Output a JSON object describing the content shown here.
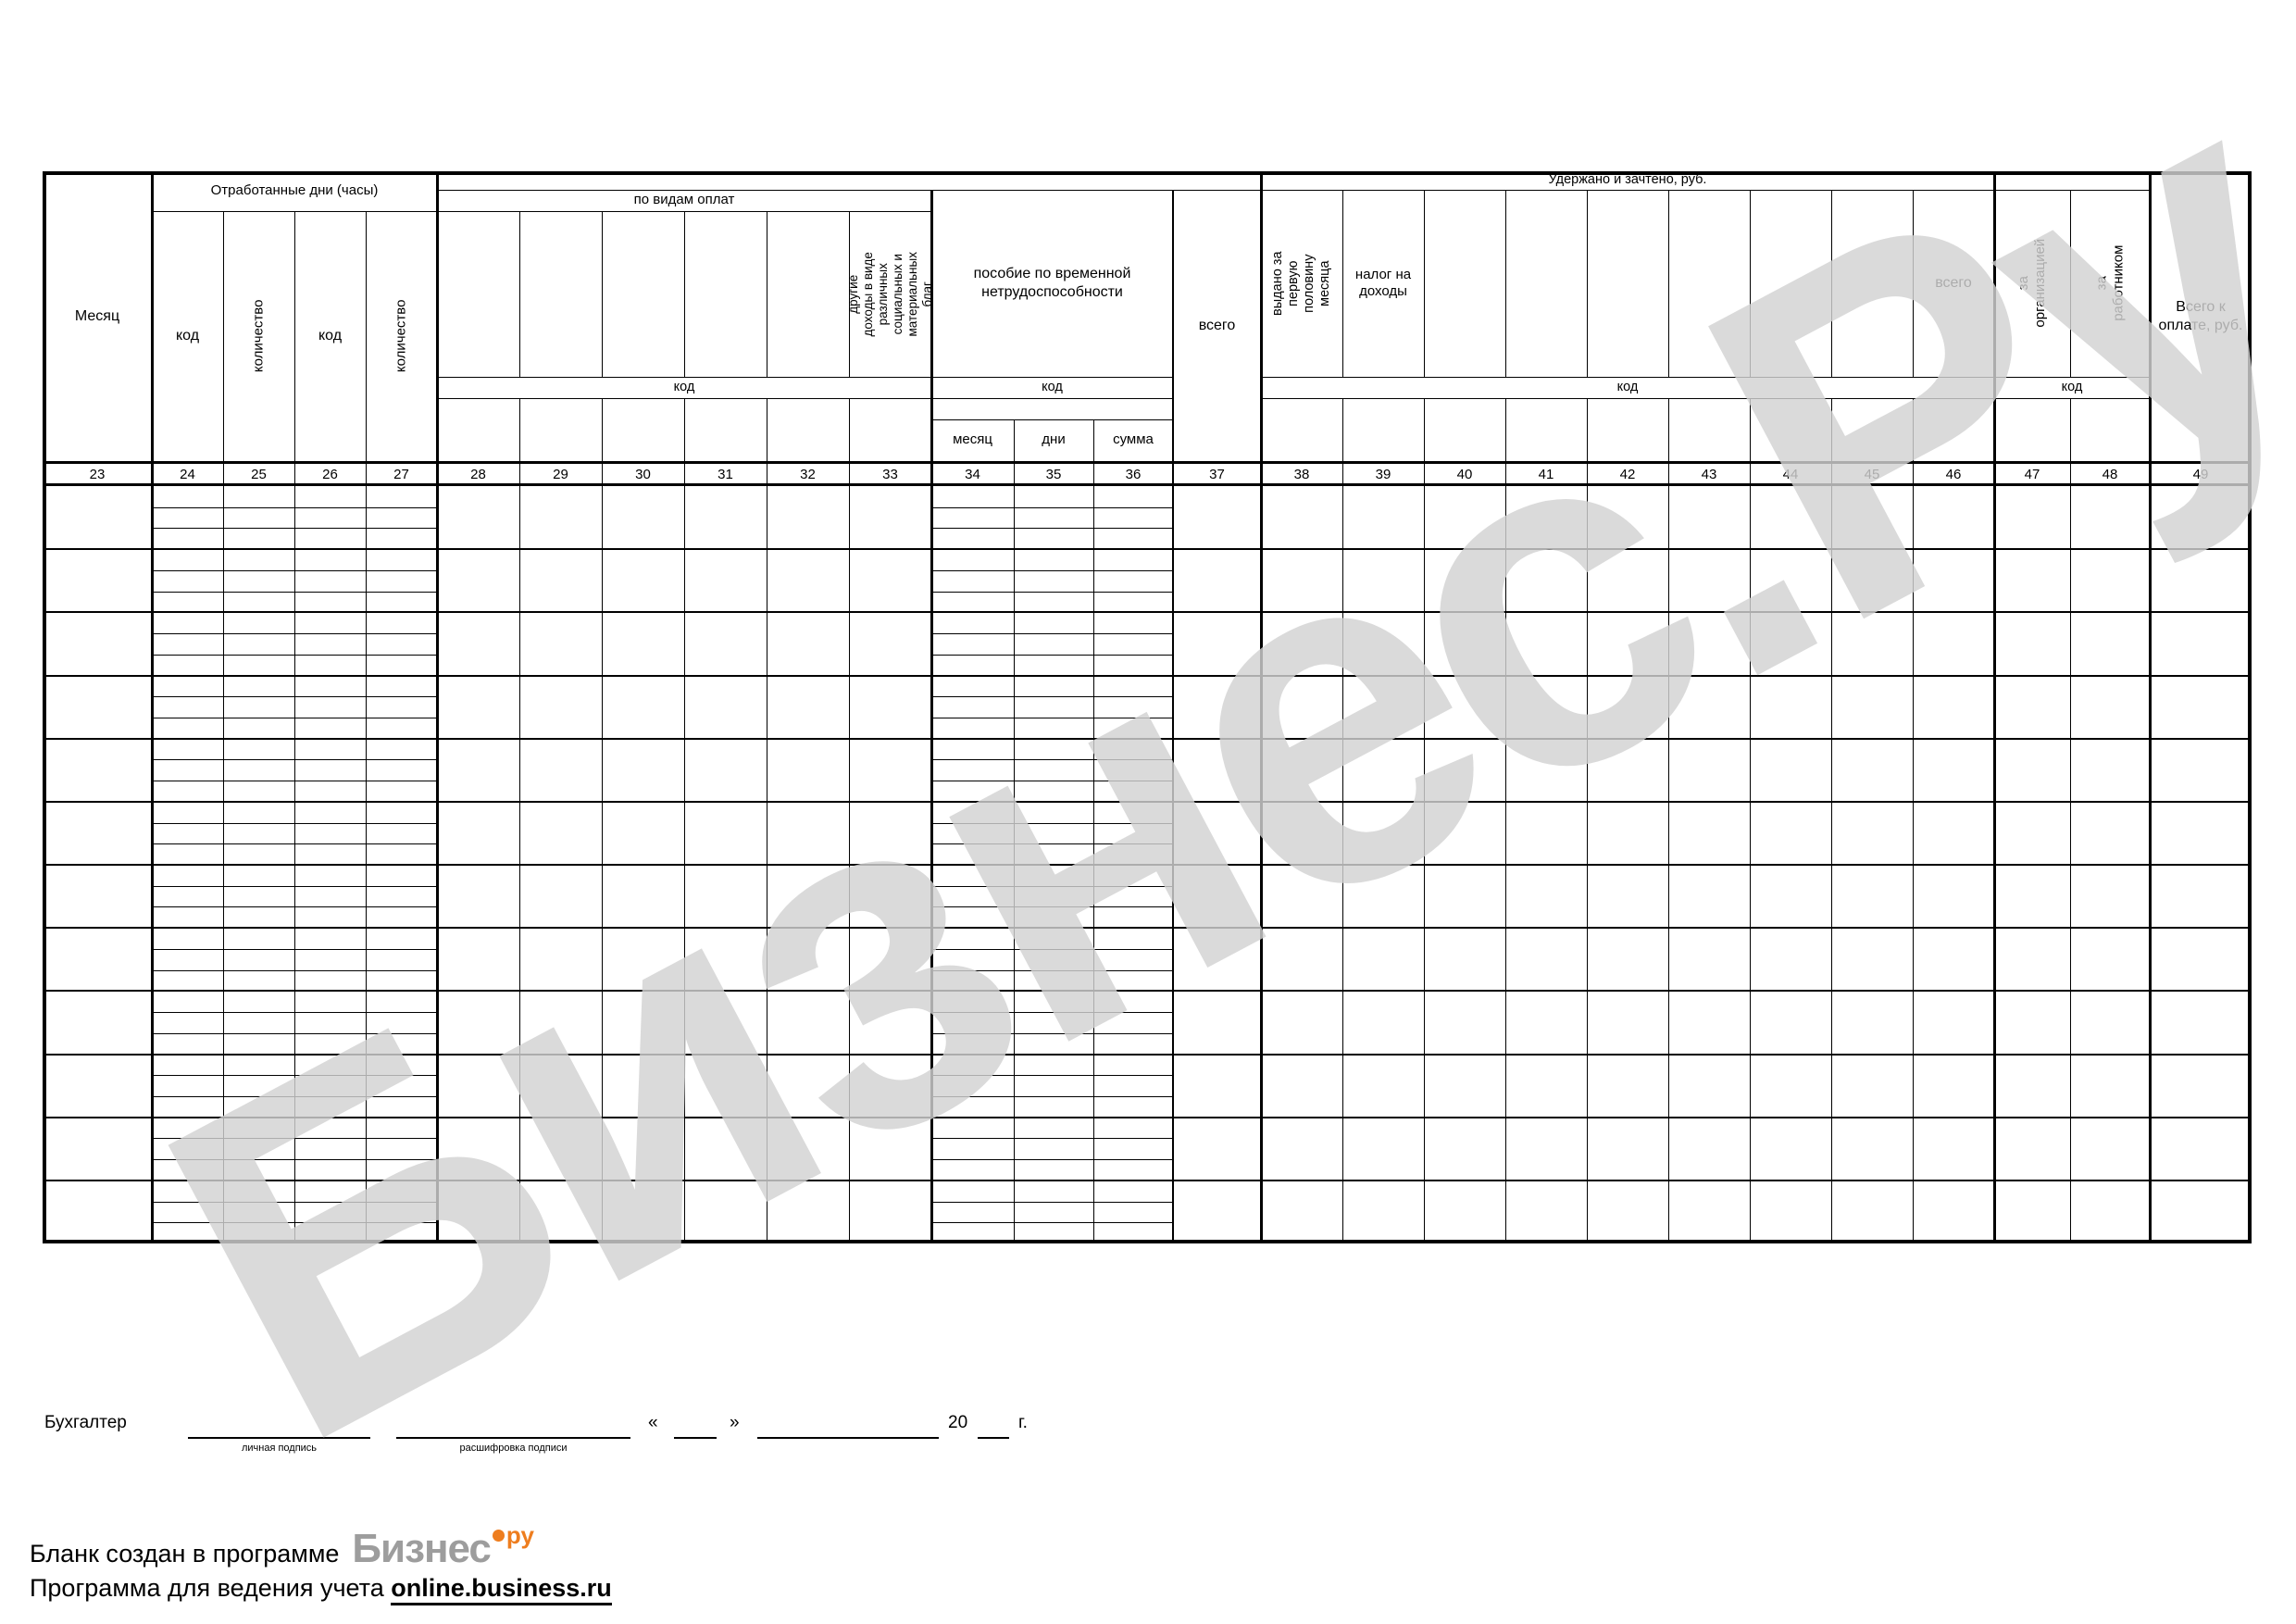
{
  "watermark": {
    "text": "Бизнес.Ру"
  },
  "header": {
    "month": "Месяц",
    "worked_days_title": "Отработанные дни (часы)",
    "worked_cols": [
      "код",
      "количество",
      "код",
      "количество"
    ],
    "payments_title": "по видам оплат",
    "other_income": "другие доходы в виде различных социальных и материальных благ",
    "code_label": "код",
    "sick_title": "пособие по временной нетрудоспособности",
    "sick_cols": [
      "месяц",
      "дни",
      "сумма"
    ],
    "total_label": "всего",
    "withheld_title": "Удержано и зачтено, руб.",
    "advance": "выдано за первую половину месяца",
    "income_tax": "налог на доходы",
    "debt_org": "за организацией",
    "debt_emp": "за работником",
    "total_to_pay": "Всего к оплате, руб."
  },
  "col_numbers": [
    "23",
    "24",
    "25",
    "26",
    "27",
    "28",
    "29",
    "30",
    "31",
    "32",
    "33",
    "34",
    "35",
    "36",
    "37",
    "38",
    "39",
    "40",
    "41",
    "42",
    "43",
    "44",
    "45",
    "46",
    "47",
    "48",
    "49"
  ],
  "months_count": 12,
  "signature": {
    "role": "Бухгалтер",
    "sig_caption": "личная подпись",
    "name_caption": "расшифровка подписи",
    "quote_open": "«",
    "quote_close": "»",
    "year_prefix": "20",
    "year_suffix": "г."
  },
  "footer": {
    "line1": "Бланк создан в программе",
    "logo": "Бизнес",
    "logo_sup": "ру",
    "line2": "Программа для ведения учета",
    "link": "online.business.ru"
  },
  "colors": {
    "logo_gray": "#9d9d9d",
    "logo_orange": "#ee7d1e",
    "watermark": "#d2d2d2"
  }
}
